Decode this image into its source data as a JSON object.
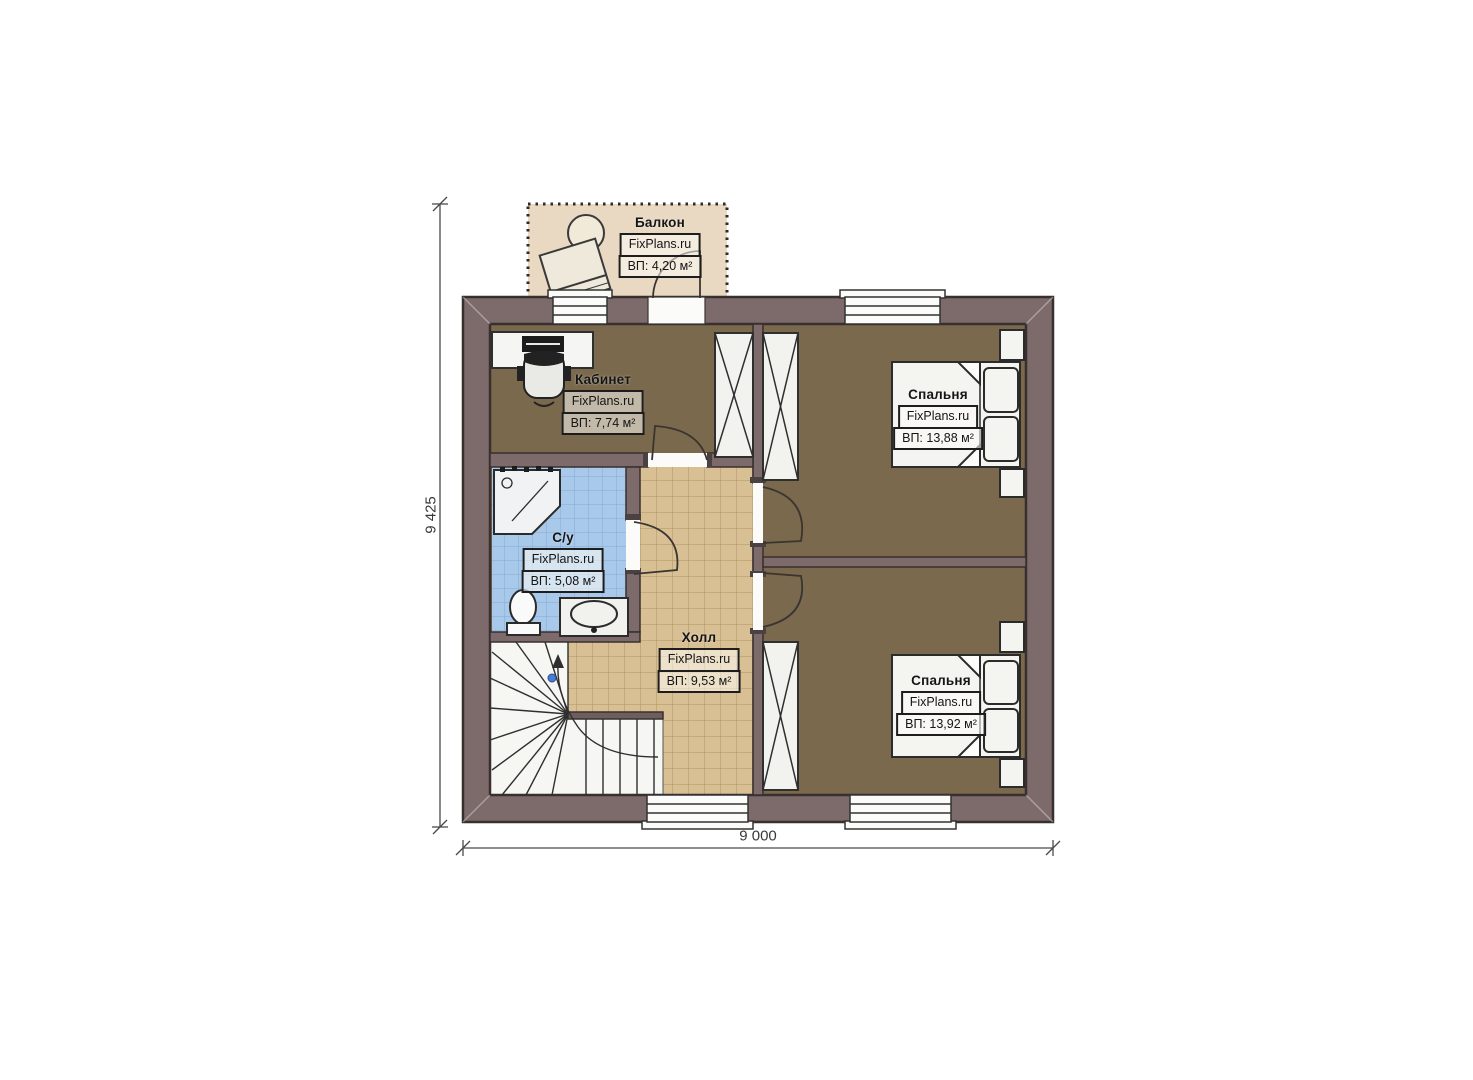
{
  "plan": {
    "brand": "FixPlans.ru",
    "rooms": {
      "balcony": {
        "title": "Балкон",
        "area": "ВП: 4,20 м²"
      },
      "office": {
        "title": "Кабинет",
        "area": "ВП: 7,74 м²"
      },
      "bedroom1": {
        "title": "Спальня",
        "area": "ВП: 13,88 м²"
      },
      "bathroom": {
        "title": "С/у",
        "area": "ВП: 5,08 м²"
      },
      "hall": {
        "title": "Холл",
        "area": "ВП: 9,53 м²"
      },
      "bedroom2": {
        "title": "Спальня",
        "area": "ВП: 13,92 м²"
      }
    },
    "dimensions": {
      "height": "9 425",
      "width": "9 000"
    },
    "colors": {
      "wall": "#7d6a6a",
      "wall_outline": "#38302e",
      "floor_wood": "#7a694d",
      "floor_hall": "#d9c094",
      "floor_bath": "#a9c9ea",
      "balcony_floor": "#e9d9c2",
      "fixture_white": "#f6f6f3",
      "walkline_dot": "#4a7dd2"
    }
  }
}
